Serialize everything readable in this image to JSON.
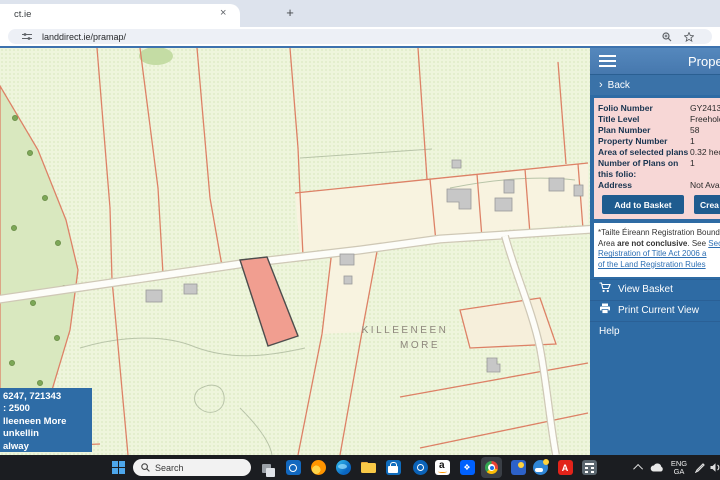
{
  "browser": {
    "tab_title": "ct.ie",
    "tab_close": "×",
    "new_tab_button": "+",
    "url": "landdirect.ie/pramap/"
  },
  "panel": {
    "title": "Prope",
    "back_label": "Back",
    "fields": [
      {
        "label": "Folio Number",
        "value": "GY24134F"
      },
      {
        "label": "Title Level",
        "value": "Freehold"
      },
      {
        "label": "Plan Number",
        "value": "58"
      },
      {
        "label": "Property Number",
        "value": "1"
      },
      {
        "label": "Area of selected plans",
        "value": "0.32 hecta"
      },
      {
        "label": "Number of Plans on this folio:",
        "value": "1"
      },
      {
        "label": "Address",
        "value": "Not Availa"
      }
    ],
    "buttons": {
      "add_to_basket": "Add to Basket",
      "create": "Crea"
    },
    "note": {
      "line1": "*Tailte Éireann Registration Bound",
      "line2_pre": "Area ",
      "line2_bold": "are not conclusive",
      "line2_mid": ". See ",
      "line2_link": "Sec",
      "line3_link": "Registration of Title Act 2006 a",
      "line4_link": "of the Land Registration Rules"
    },
    "menu": {
      "view_basket": "View Basket",
      "print": "Print Current View",
      "help": "Help"
    }
  },
  "map": {
    "townland_label": {
      "line1": "KILLEENEEN",
      "line2": "MORE"
    },
    "info_box": {
      "line1": "6247, 721343",
      "line2": ": 2500",
      "line3": "lleeneen More",
      "line4": "unkellin",
      "line5": "alway"
    }
  },
  "taskbar": {
    "search_placeholder": "Search",
    "language": {
      "line1": "ENG",
      "line2": "GA"
    },
    "icons": [
      "start",
      "search",
      "task-view",
      "outlook",
      "firefox",
      "edge",
      "file-explorer",
      "store",
      "outlook",
      "amazon",
      "dropbox",
      "chrome",
      "photos",
      "weather",
      "acrobat",
      "calculator",
      "hidden-icons",
      "onedrive",
      "language",
      "volume"
    ]
  },
  "colors": {
    "panel_blue": "#2e6ba4",
    "panel_header_blue": "#4d80b6",
    "pink_box": "#f7d7d6",
    "button_blue": "#1f5c8f",
    "map_background": "#eef5dc",
    "parcel_boundary": "#dd8166",
    "selected_parcel_fill": "#f19e90",
    "woodland_green": "#d9e8bf",
    "chrome_accent_line": "#3d72ae",
    "taskbar_dark": "#1b1d21",
    "info_box_blue": "#2e6ca6"
  }
}
